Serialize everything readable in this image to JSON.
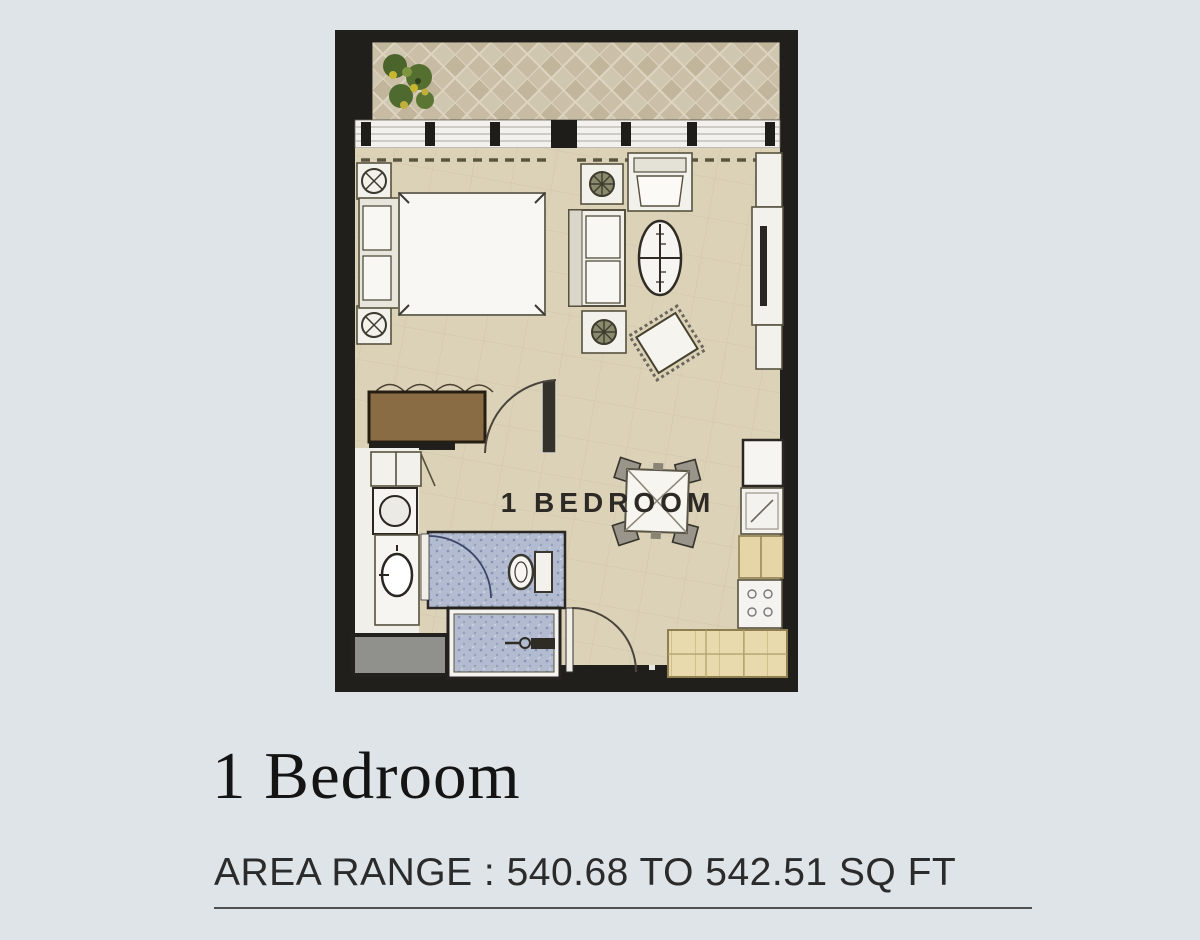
{
  "floorplan": {
    "label": "1 BEDROOM"
  },
  "details": {
    "title": "1 Bedroom",
    "area_range": "AREA RANGE : 540.68 TO 542.51 SQ FT"
  },
  "colors": {
    "bg": "#dfe4e8",
    "wall": "#211f1c",
    "floor": "#dcd2b8",
    "balcony-tile": "#c6bba1",
    "bath-tile": "#b2bbd0",
    "wood": "#8a6c44",
    "counter": "#e8daad",
    "gray-unit": "#90908c",
    "label": "#2d2a26",
    "title": "#141414",
    "text": "#2b2b2b",
    "line": "#4f4f4f",
    "plant": "#55702f",
    "plant-accent": "#c2ae3a"
  }
}
